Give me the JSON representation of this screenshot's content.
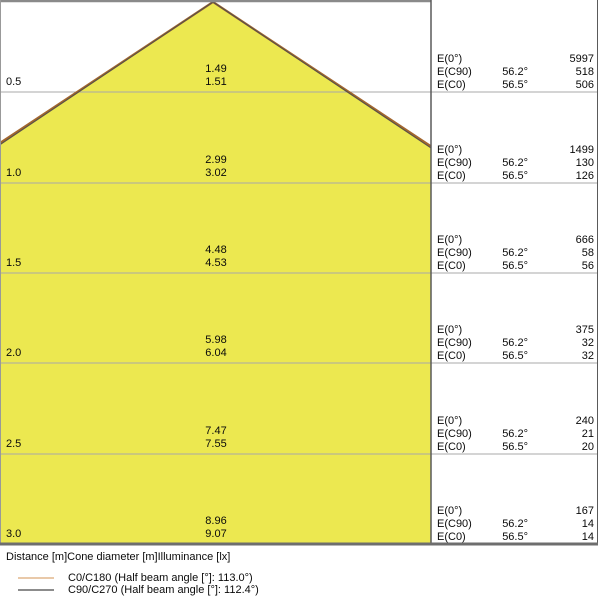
{
  "colors": {
    "cone_fill": "#ECE850",
    "cone_edge_c0": "#A3672F",
    "cone_edge_c90": "#5C5148",
    "grid_line": "#A8A8A8",
    "border_dark": "#6E6E6E",
    "border_light": "#999999",
    "legend_c0": "#E9C9A9",
    "legend_c90": "#8C8C8C",
    "text": "#0A0A0A"
  },
  "chart_data": {
    "type": "table",
    "title": "Luminaire light cone diagram (distance / cone diameter / illuminance)",
    "columns": [
      "Distance [m]",
      "Cone diameter C90/C270 [m]",
      "Cone diameter C0/C180 [m]",
      "E(0°) [lx]",
      "E(C90) [lx]",
      "E(C0) [lx]"
    ],
    "rows": [
      [
        0.5,
        1.49,
        1.51,
        5997,
        518,
        506
      ],
      [
        1.0,
        2.99,
        3.02,
        1499,
        130,
        126
      ],
      [
        1.5,
        4.48,
        4.53,
        666,
        58,
        56
      ],
      [
        2.0,
        5.98,
        6.04,
        375,
        32,
        32
      ],
      [
        2.5,
        7.47,
        7.55,
        240,
        21,
        20
      ],
      [
        3.0,
        8.96,
        9.07,
        167,
        14,
        14
      ]
    ],
    "beam": {
      "c0_c180_beam_angle_deg": 113.0,
      "c90_c270_beam_angle_deg": 112.4,
      "e_c90_angle_label": "56.2°",
      "e_c0_angle_label": "56.5°"
    },
    "axis_max_distance_m": 3.0,
    "legend_position": "bottom"
  },
  "diagram": {
    "blocks": [
      {
        "distance_label": "0.5",
        "cone_diameters": [
          "1.49",
          "1.51"
        ],
        "table_rows": [
          {
            "label": "E(0°)",
            "angle": "",
            "value": "5997"
          },
          {
            "label": "E(C90)",
            "angle": "56.2°",
            "value": "518"
          },
          {
            "label": "E(C0)",
            "angle": "56.5°",
            "value": "506"
          }
        ]
      },
      {
        "distance_label": "1.0",
        "cone_diameters": [
          "2.99",
          "3.02"
        ],
        "table_rows": [
          {
            "label": "E(0°)",
            "angle": "",
            "value": "1499"
          },
          {
            "label": "E(C90)",
            "angle": "56.2°",
            "value": "130"
          },
          {
            "label": "E(C0)",
            "angle": "56.5°",
            "value": "126"
          }
        ]
      },
      {
        "distance_label": "1.5",
        "cone_diameters": [
          "4.48",
          "4.53"
        ],
        "table_rows": [
          {
            "label": "E(0°)",
            "angle": "",
            "value": "666"
          },
          {
            "label": "E(C90)",
            "angle": "56.2°",
            "value": "58"
          },
          {
            "label": "E(C0)",
            "angle": "56.5°",
            "value": "56"
          }
        ]
      },
      {
        "distance_label": "2.0",
        "cone_diameters": [
          "5.98",
          "6.04"
        ],
        "table_rows": [
          {
            "label": "E(0°)",
            "angle": "",
            "value": "375"
          },
          {
            "label": "E(C90)",
            "angle": "56.2°",
            "value": "32"
          },
          {
            "label": "E(C0)",
            "angle": "56.5°",
            "value": "32"
          }
        ]
      },
      {
        "distance_label": "2.5",
        "cone_diameters": [
          "7.47",
          "7.55"
        ],
        "table_rows": [
          {
            "label": "E(0°)",
            "angle": "",
            "value": "240"
          },
          {
            "label": "E(C90)",
            "angle": "56.2°",
            "value": "21"
          },
          {
            "label": "E(C0)",
            "angle": "56.5°",
            "value": "20"
          }
        ]
      },
      {
        "distance_label": "3.0",
        "cone_diameters": [
          "8.96",
          "9.07"
        ],
        "table_rows": [
          {
            "label": "E(0°)",
            "angle": "",
            "value": "167"
          },
          {
            "label": "E(C90)",
            "angle": "56.2°",
            "value": "14"
          },
          {
            "label": "E(C0)",
            "angle": "56.5°",
            "value": "14"
          }
        ]
      }
    ]
  },
  "footer": {
    "caption": "Distance [m]Cone diameter [m]Illuminance [lx]",
    "legend": [
      {
        "label": "C0/C180 (Half beam angle [°]: 113.0°)",
        "color": "#E9C9A9"
      },
      {
        "label": "C90/C270 (Half beam angle [°]: 112.4°)",
        "color": "#8C8C8C"
      }
    ]
  }
}
